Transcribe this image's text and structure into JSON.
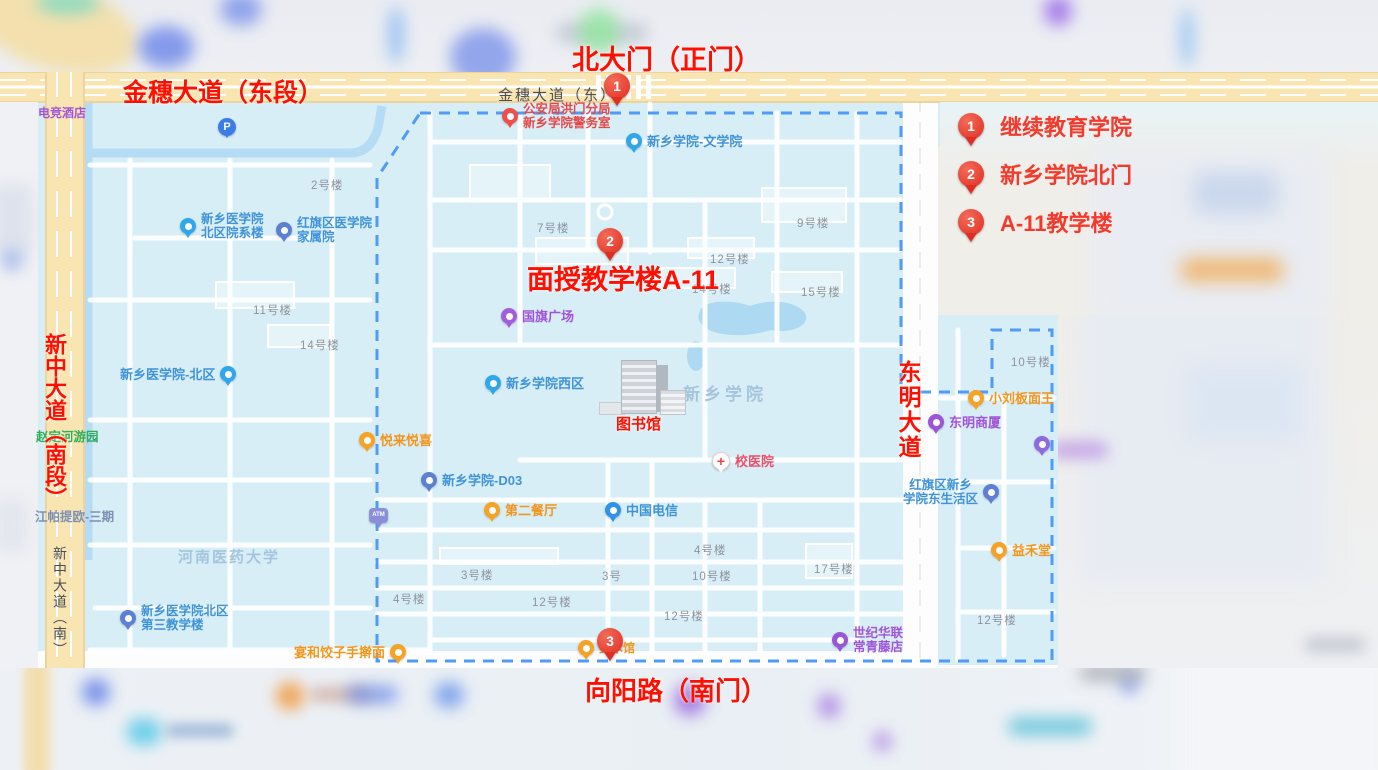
{
  "annotations": {
    "north_gate": "北大门（正门）",
    "jinsui_e_seg": "金穗大道（东段）",
    "mianshou_a11": "面授教学楼A-11",
    "xinzhong_s_seg": "新中大道（南段）",
    "dongming": "东明大道",
    "xiangyang_s": "向阳路（南门）",
    "library": "图书馆"
  },
  "legend": [
    {
      "num": "1",
      "label": "继续教育学院"
    },
    {
      "num": "2",
      "label": "新乡学院北门"
    },
    {
      "num": "3",
      "label": "A-11教学楼"
    }
  ],
  "map_markers": [
    "1",
    "2",
    "3"
  ],
  "roads": {
    "jinsui_east": "金穗大道（东）",
    "xinzhong_south": "新中大道（南）"
  },
  "areas": {
    "henan_medical": "河南医药大学",
    "xinxiang_univ": "新乡学院"
  },
  "pois": {
    "dianjing_hotel": "电竞酒店",
    "parking": "P",
    "police": "公安局洪门分局\n新乡学院警务室",
    "wenxueyuan": "新乡学院-文学院",
    "yuanxilou": "新乡医学院\n北区院系楼",
    "jiashuyuan": "红旗区医学院\n家属院",
    "beiqu": "新乡医学院-北区",
    "xiqu": "新乡学院西区",
    "guoqi": "国旗广场",
    "zhaoding": "赵定河游园",
    "jiangpa": "江帕提欧-三期",
    "yuelai": "悦来悦喜",
    "d03": "新乡学院-D03",
    "atm": "ATM",
    "diercanting": "第二餐厅",
    "dianxin": "中国电信",
    "xiaoyiyuan": "校医院",
    "henan3jiaoxue": "新乡医学院北区\n第三教学楼",
    "yanhe": "宴和饺子手擀面",
    "meishuguan": "美术馆",
    "shijihualian": "世纪华联\n常青藤店",
    "xiaoliu": "小刘板面王",
    "dongmingshasha": "东明商厦",
    "shenghuoqu": "红旗区新乡\n学院东生活区",
    "yihetang": "益禾堂"
  },
  "buildings": {
    "b2": "2号楼",
    "b7": "7号楼",
    "b9": "9号楼",
    "b11": "11号楼",
    "b12a": "12号楼",
    "b12b": "12号楼",
    "b12c": "12号楼",
    "b12d": "12号楼",
    "b14a": "14号楼",
    "b14b": "14号楼",
    "b15": "15号楼",
    "b17": "17号楼",
    "b3": "3号楼",
    "no3": "3号",
    "b4a": "4号楼",
    "b4b": "4号楼",
    "b10a": "10号楼",
    "b10b": "10号楼"
  }
}
